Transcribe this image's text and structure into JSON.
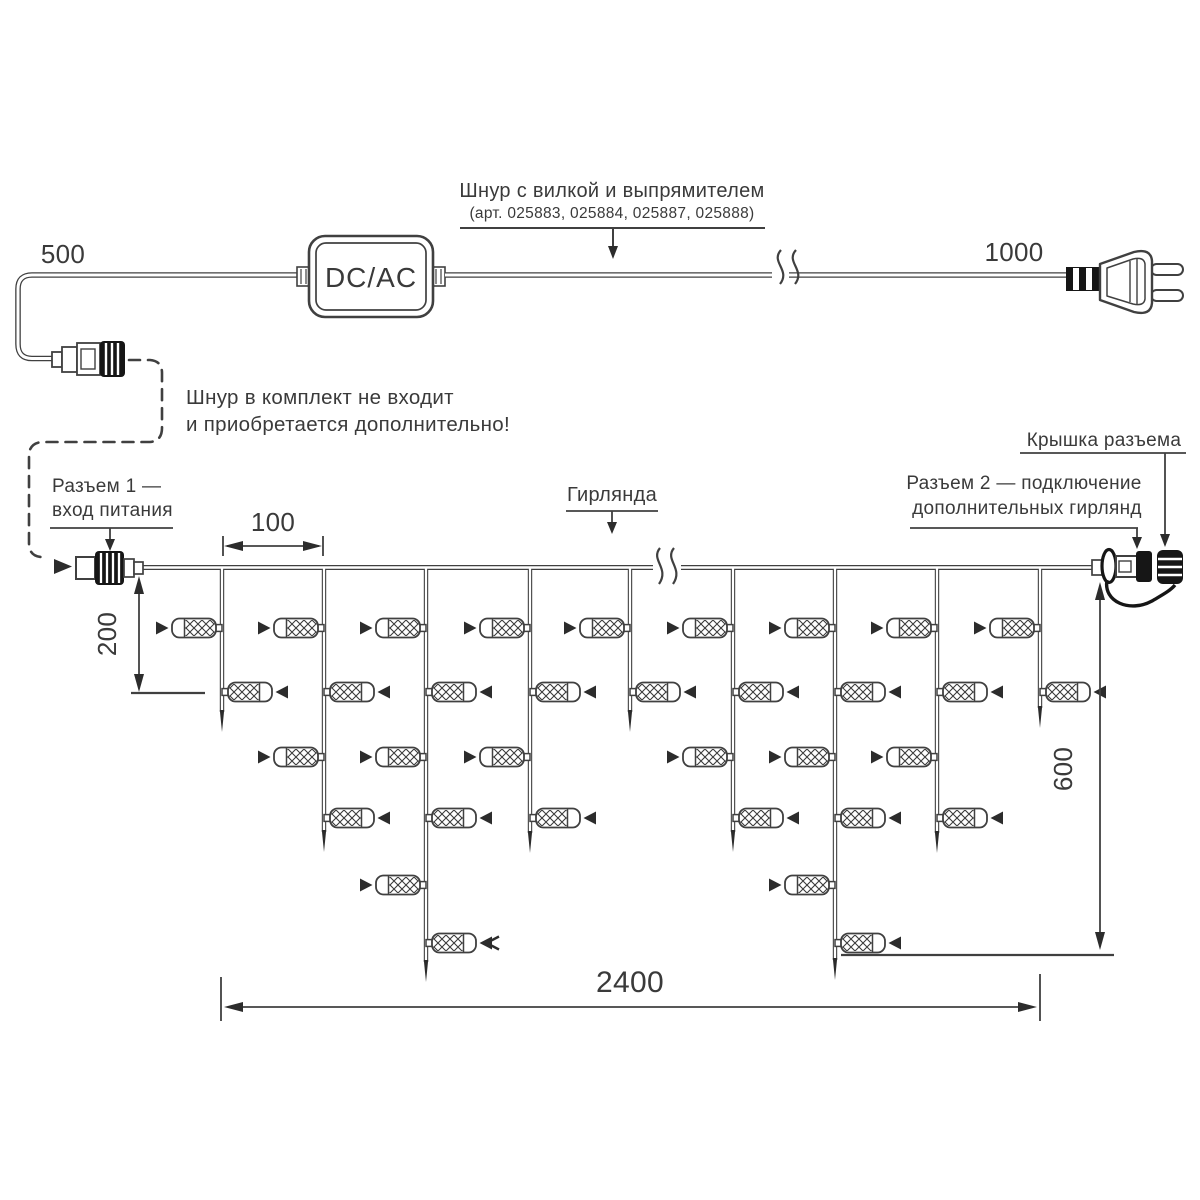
{
  "title_block": {
    "cord_label": "Шнур с вилкой и выпрямителем",
    "cord_articles": "(арт. 025883, 025884, 025887, 025888)",
    "converter_label": "DC/AC",
    "note_line1": "Шнур в комплект не входит",
    "note_line2": "и приобретается дополнительно!"
  },
  "connectors": {
    "connector1_line1": "Разъем 1 —",
    "connector1_line2": "вход питания",
    "connector2_line1": "Разъем 2 — подключение",
    "connector2_line2": "дополнительных гирлянд",
    "cap_label": "Крышка разъема",
    "garland_label": "Гирлянда"
  },
  "dimensions": {
    "cord_length_left": "500",
    "cord_length_right": "1000",
    "drop_spacing": "100",
    "short_drop_height": "200",
    "max_drop_height": "600",
    "garland_length": "2400"
  }
}
